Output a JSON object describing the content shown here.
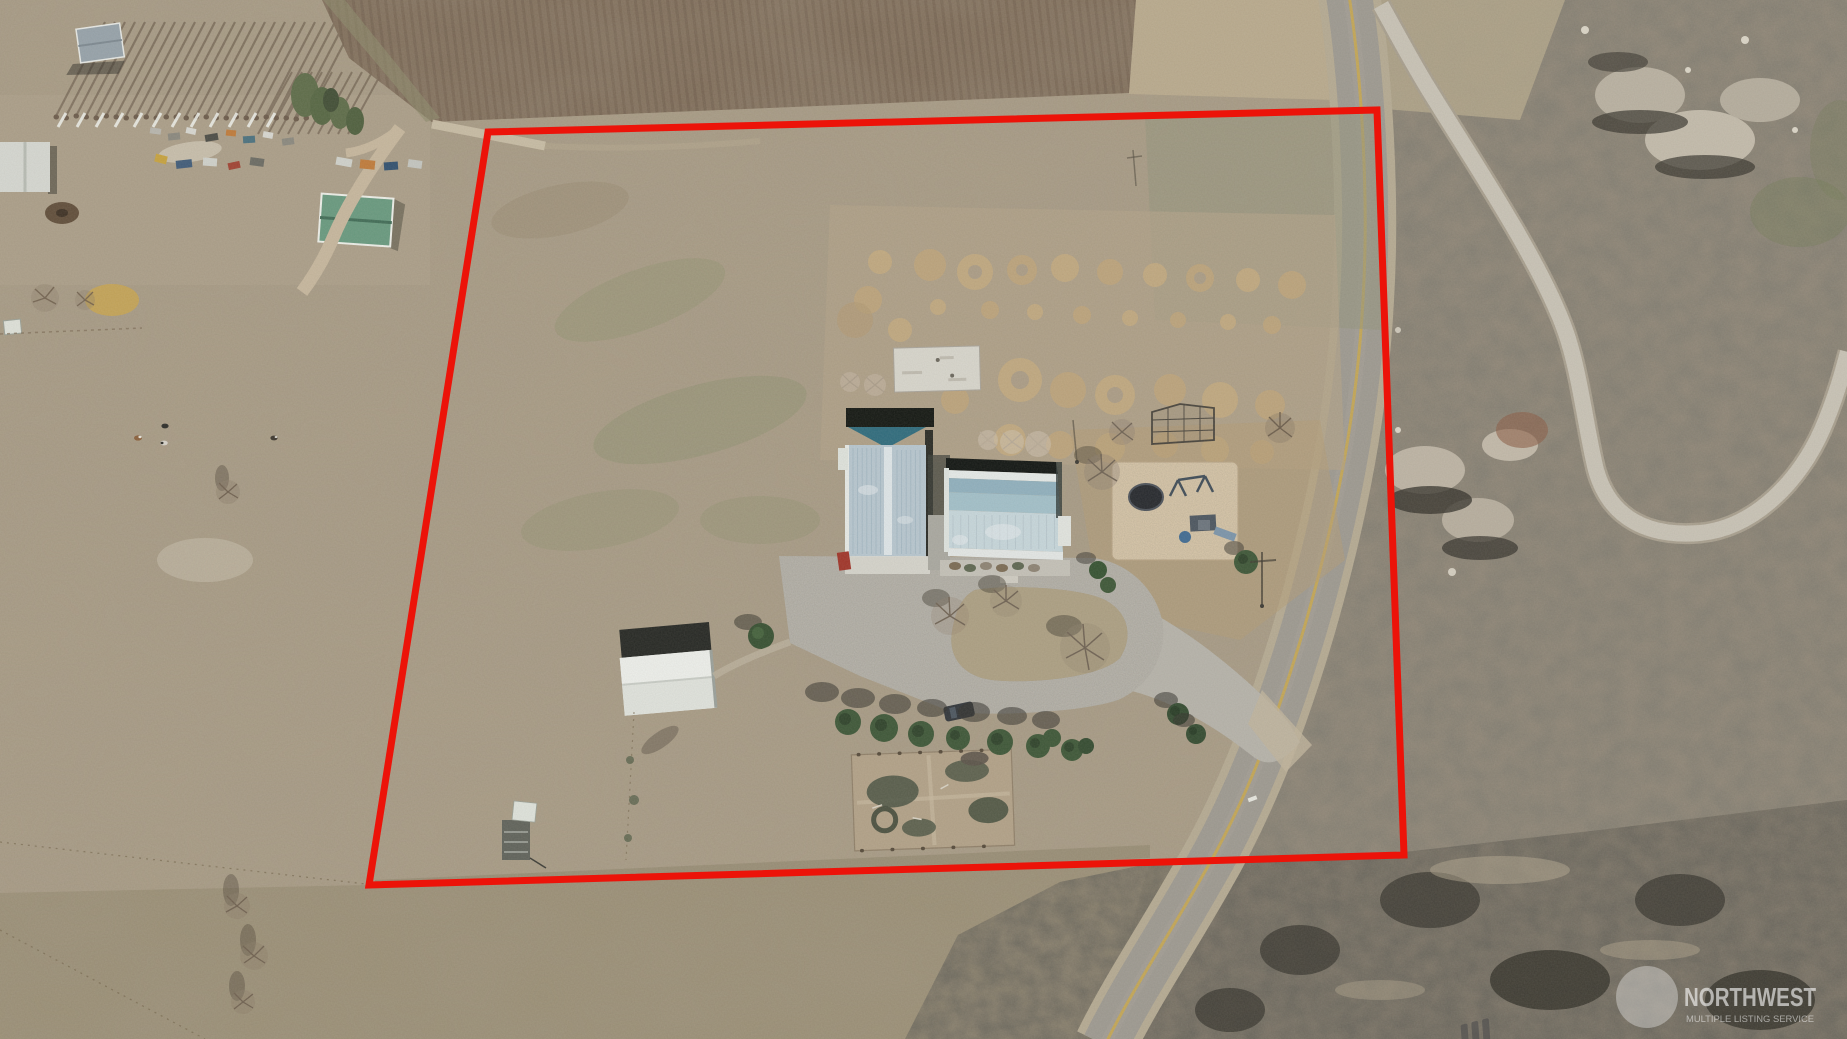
{
  "image": {
    "kind": "aerial-drone-photograph",
    "width_px": 1847,
    "height_px": 1039,
    "description": "Overhead aerial photo of a rural acreage with a red property-boundary outline drawn over dry pasture, farm buildings, a highway and sagebrush scrubland"
  },
  "watermark": {
    "brand": "NORTHWEST",
    "tagline": "MULTIPLE LISTING SERVICE",
    "logo_icon": "mls-three-stripes-logo"
  },
  "property_boundary": {
    "color": "#ec1309",
    "stroke_width": 7,
    "points_str": "488,132 1377,110 1404,855 369,885"
  },
  "scene": {
    "features": [
      "plowed brown field (north)",
      "dry gray-tan pasture",
      "two-lane highway with double yellow centerline",
      "winding gravel road through scrub (east)",
      "sagebrush scrubland with rock outcrops",
      "house with light-blue metal roof",
      "barn-shop with teal gable and blue metal roof",
      "white storage shed",
      "concrete loop driveway with grass island",
      "sand playground lot with play structure and trampoline",
      "baseball backstop cage",
      "fenced garden plot",
      "evergreen tree row",
      "neighboring farmstead with poplar windbreak (northwest)"
    ]
  },
  "palette": {
    "boundary_red": "#ec1309",
    "asphalt": "#9d9990",
    "center_line_yellow": "#c8a74e",
    "gravel_road": "#c9c3b6",
    "pasture": "#a89b84",
    "plowed_field": "#7e6b57",
    "scrub": "#8e8576",
    "roof_teal": "#2c6a7c",
    "roof_blue_light": "#c7d7dc",
    "roof_blue_mid": "#a2c0ca",
    "shed_white": "#e9ebe6",
    "concrete": "#b6b3aa",
    "sand": "#d9c7a9"
  }
}
